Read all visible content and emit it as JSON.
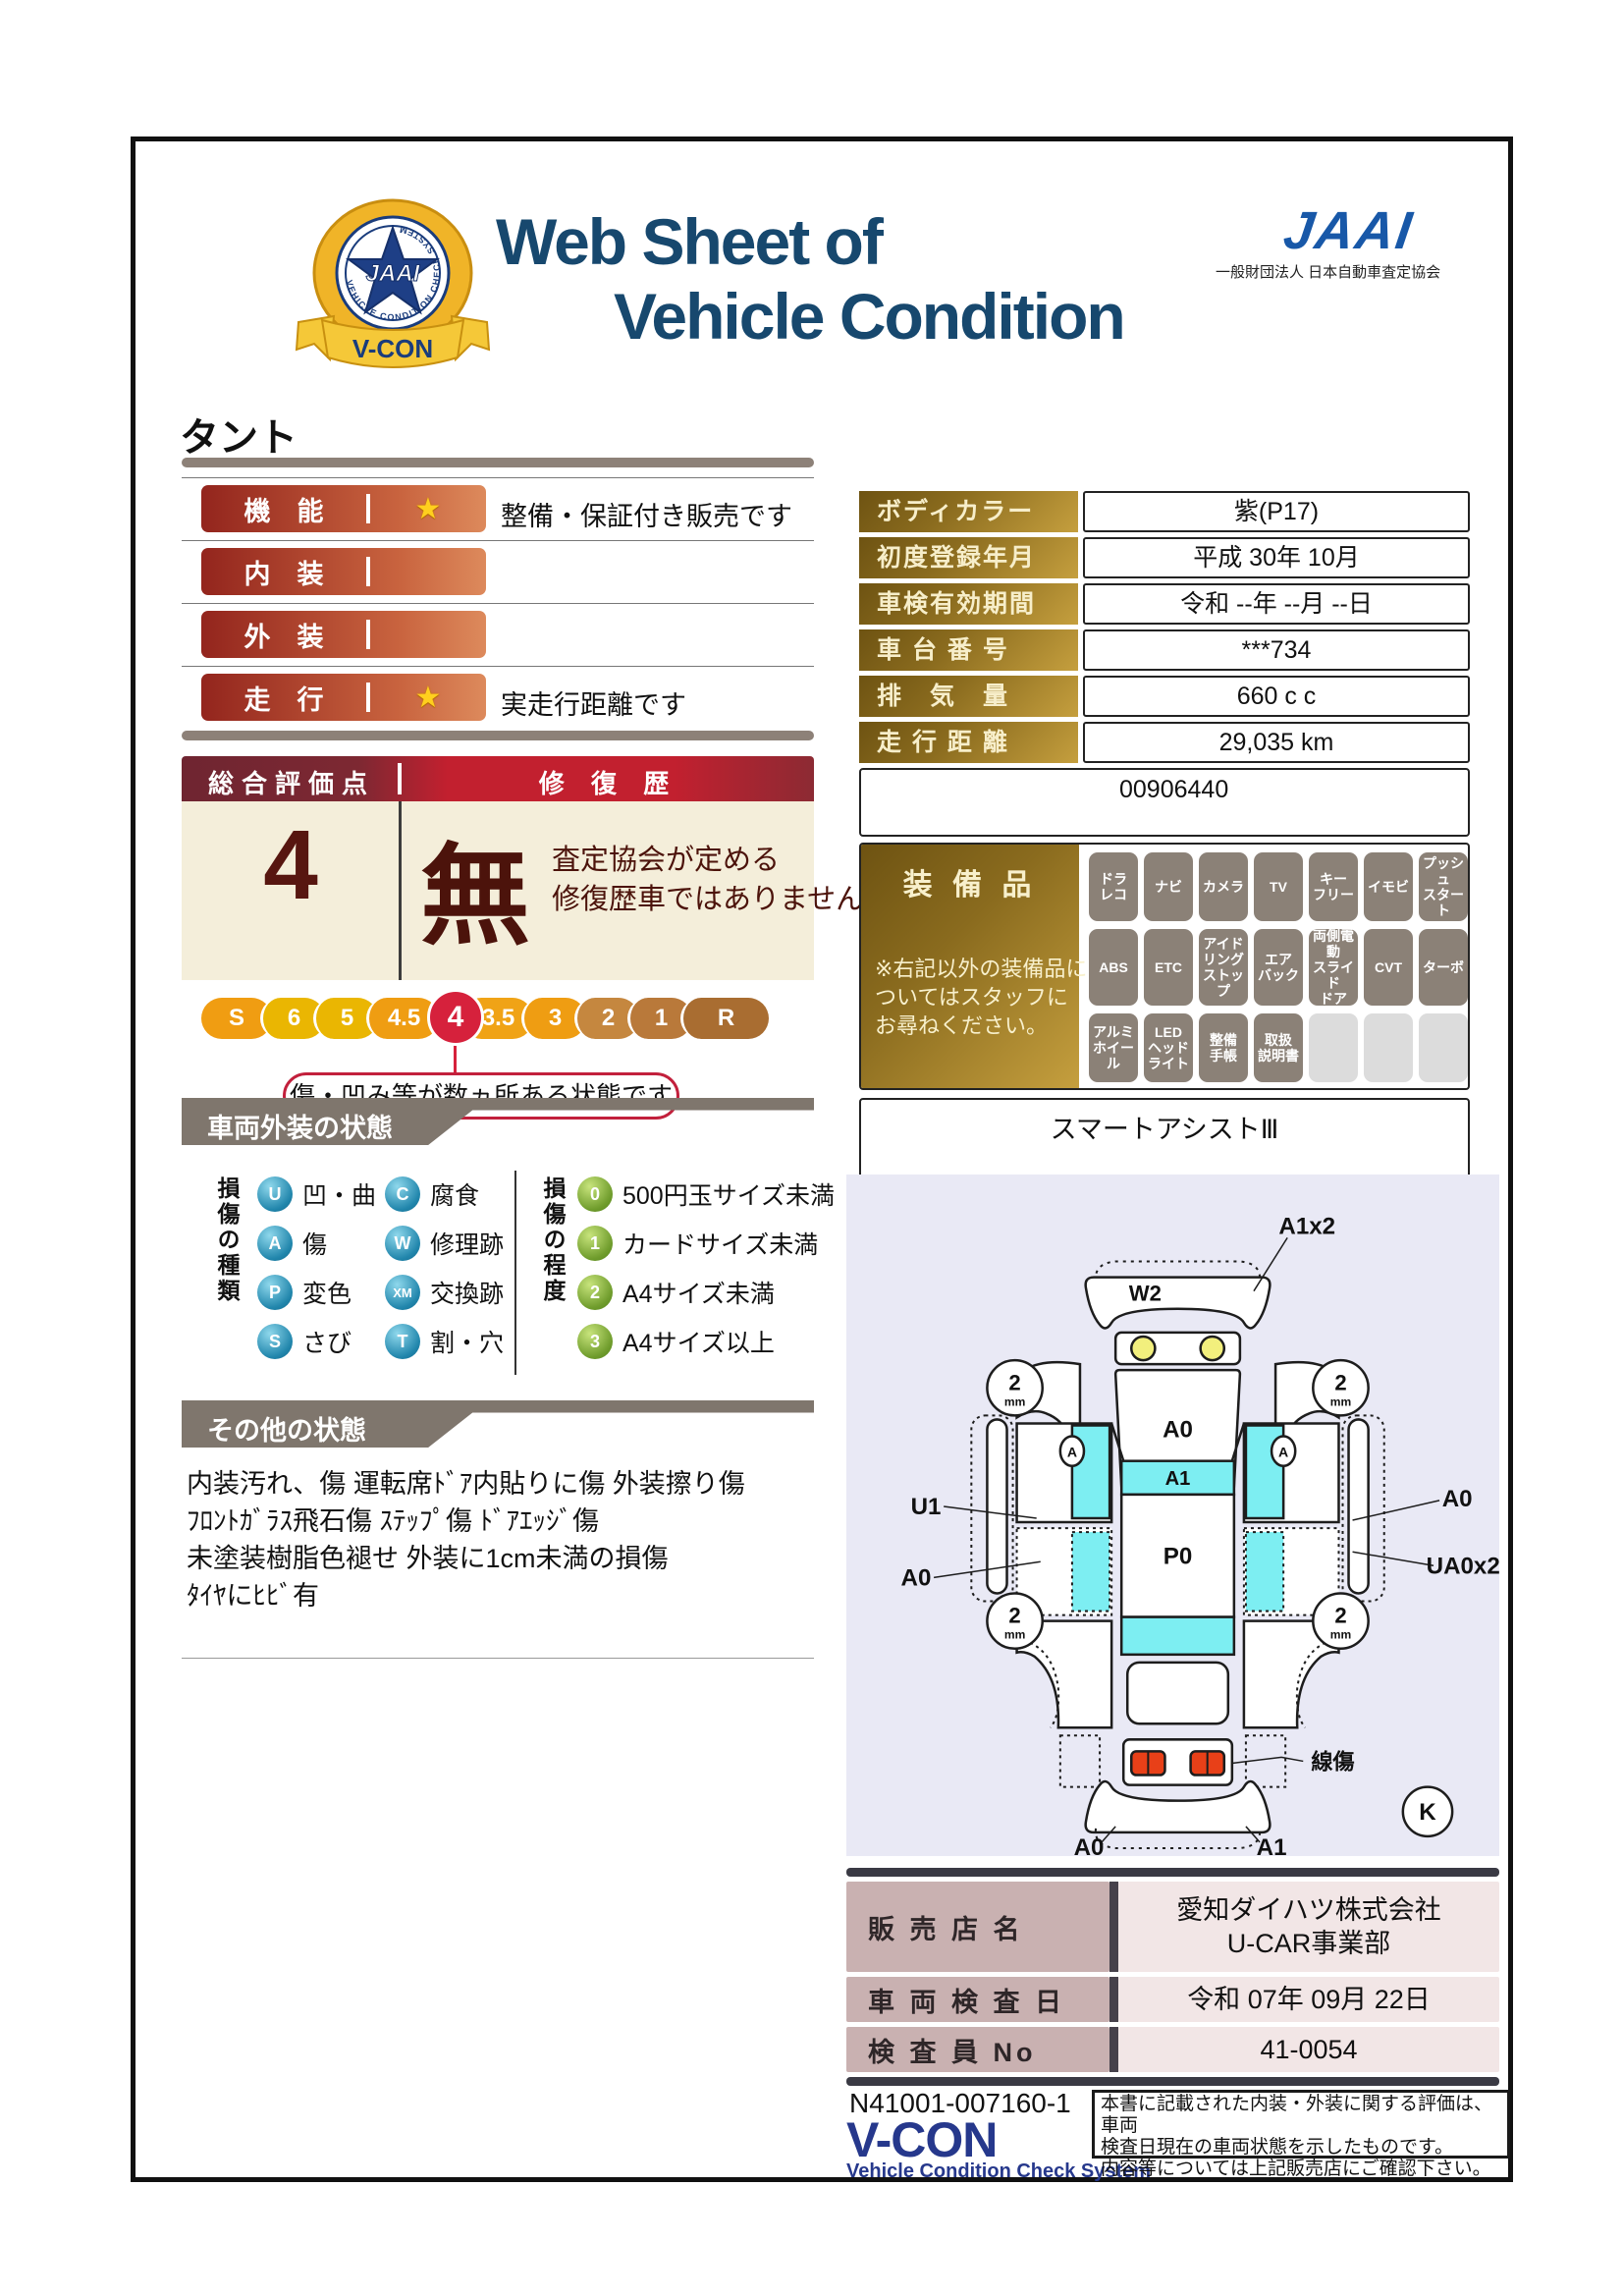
{
  "header": {
    "title_line1": "Web Sheet of",
    "title_line2": "Vehicle Condition",
    "jaai_logo": "JAAI",
    "jaai_subtitle": "一般財団法人 日本自動車査定協会",
    "emblem": {
      "center": "JAAI",
      "ring_text": "VEHICLE CONDITION CHECK SYSTEM",
      "ribbon": "V-CON"
    }
  },
  "vehicle_name": "タント",
  "ratings": {
    "rows": [
      {
        "label": "機　能",
        "star": true,
        "note": "整備・保証付き販売です"
      },
      {
        "label": "内　装",
        "star": false,
        "note": ""
      },
      {
        "label": "外　装",
        "star": false,
        "note": ""
      },
      {
        "label": "走　行",
        "star": true,
        "note": "実走行距離です"
      }
    ]
  },
  "overall": {
    "header_left": "総合評価点",
    "header_right": "修 復 歴",
    "score": "4",
    "repair_kanji": "無",
    "repair_note": "査定協会が定める\n修復歴車ではありません",
    "scale": [
      "S",
      "6",
      "5",
      "4.5",
      "4",
      "3.5",
      "3",
      "2",
      "1",
      "R"
    ],
    "selected": "4",
    "scale_note": "傷・凹み等が数ヵ所ある状態です"
  },
  "info_table": {
    "rows": [
      {
        "label": "ボディカラー",
        "value": "紫(P17)"
      },
      {
        "label": "初度登録年月",
        "value": "平成 30年 10月"
      },
      {
        "label": "車検有効期間",
        "value": "令和 --年 --月 --日"
      },
      {
        "label": "車 台 番 号",
        "value": "***734"
      },
      {
        "label": "排　気　量",
        "value": "660 c c"
      },
      {
        "label": "走 行 距 離",
        "value": "29,035 km"
      }
    ],
    "id_number": "00906440"
  },
  "equipment": {
    "title": "装 備 品",
    "note": "※右記以外の装備品に\nついてはスタッフに\nお尋ねください。",
    "row1": [
      "ドラ\nレコ",
      "ナビ",
      "カメラ",
      "TV",
      "キー\nフリー",
      "イモビ",
      "プッシュ\nスタート"
    ],
    "row2": [
      "ABS",
      "ETC",
      "アイド\nリング\nストップ",
      "エア\nバック",
      "両側電動\nスライド\nドア",
      "CVT",
      "ターボ"
    ],
    "row3": [
      "アルミ\nホイール",
      "LED\nヘッド\nライト",
      "整備\n手帳",
      "取扱\n説明書"
    ],
    "extra": "スマートアシストⅢ"
  },
  "exterior": {
    "section_title": "車両外装の状態",
    "type_label": "損傷の種類",
    "types": [
      {
        "code": "U",
        "label": "凹・曲"
      },
      {
        "code": "A",
        "label": "傷"
      },
      {
        "code": "P",
        "label": "変色"
      },
      {
        "code": "S",
        "label": "さび"
      },
      {
        "code": "C",
        "label": "腐食"
      },
      {
        "code": "W",
        "label": "修理跡"
      },
      {
        "code": "XM",
        "label": "交換跡"
      },
      {
        "code": "T",
        "label": "割・穴"
      }
    ],
    "degree_label": "損傷の程度",
    "degrees": [
      {
        "code": "0",
        "label": "500円玉サイズ未満"
      },
      {
        "code": "1",
        "label": "カードサイズ未満"
      },
      {
        "code": "2",
        "label": "A4サイズ未満"
      },
      {
        "code": "3",
        "label": "A4サイズ以上"
      }
    ]
  },
  "other": {
    "section_title": "その他の状態",
    "text": "内装汚れ、傷 運転席ﾄﾞｱ内貼りに傷 外装擦り傷\nﾌﾛﾝﾄｶﾞﾗｽ飛石傷 ｽﾃｯﾌﾟ傷 ﾄﾞｱｴｯｼﾞ傷\n未塗装樹脂色褪せ 外装に1cm未満の損傷\nﾀｲﾔにﾋﾋﾞ有"
  },
  "diagram": {
    "labels": {
      "a1x2": "A1x2",
      "w2": "W2",
      "hood": "A0",
      "windshield": "A1",
      "roof": "P0",
      "u1": "U1",
      "right_a0": "A0",
      "ua0x2": "UA0x2",
      "left_a0": "A0",
      "line_scratch": "線傷",
      "bumper_a0": "A0",
      "bumper_a1": "A1",
      "k": "K",
      "wheel_num": "2",
      "wheel_unit": "mm",
      "a_marker": "A"
    }
  },
  "dealer": {
    "rows": [
      {
        "label": "販 売 店 名",
        "value": "愛知ダイハツ株式会社\nU-CAR事業部"
      },
      {
        "label": "車 両 検 査 日",
        "value": "令和 07年 09月 22日"
      },
      {
        "label": "検 査 員 No",
        "value": "41-0054"
      }
    ]
  },
  "footer": {
    "doc_number": "N41001-007160-1",
    "vcon": "V-CON",
    "vcon_sub": "Vehicle Condition Check System",
    "disclaimer": "本書に記載された内装・外装に関する評価は、車両\n検査日現在の車両状態を示したものです。\n内容等については上記販売店にご確認下さい。"
  },
  "colors": {
    "title_blue": "#17486e",
    "jaai_blue": "#1858a8",
    "vcon_blue": "#26388c",
    "bar_red": "#93251d",
    "bar_orange": "#dd8a5c",
    "gold_dark": "#6e5312",
    "gold_light": "#c59f3e",
    "maroon": "#6f2531",
    "bright_red": "#c2202f",
    "cream": "#f4eeda",
    "selected_red": "#d6213c",
    "section_gray": "#7f766d",
    "legend_blue": "#2186ac",
    "legend_green": "#6f9c2c",
    "diagram_bg": "#e9e9f5",
    "cyan": "#7deef2",
    "dealer_label_pink": "#c9b1b1",
    "dealer_value_pink": "#f2e6e6"
  }
}
